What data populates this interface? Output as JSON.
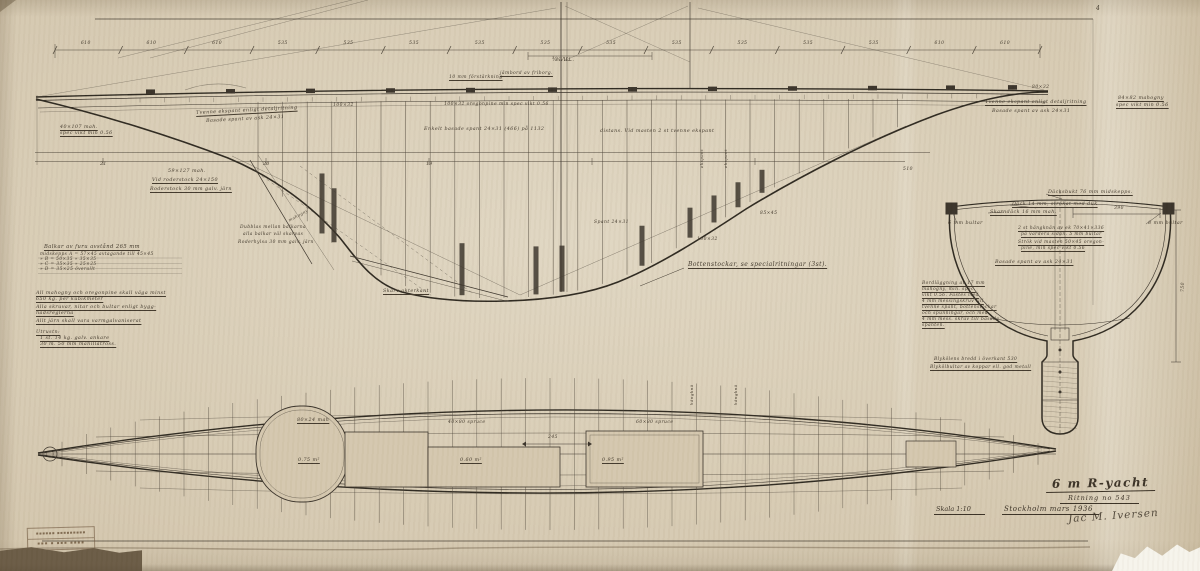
{
  "colors": {
    "paper": "#d3c6ad",
    "ink": "#3a332a",
    "heavy_ink": "#2e2920",
    "backing": "#6a5b45",
    "torn_paper": "#f6f4ec"
  },
  "title_block": {
    "title": "6 m R-yacht",
    "drawing_no": "Ritning no 543",
    "scale": "Skala 1:10",
    "place_date": "Stockholm mars 1936",
    "signature": "Jac M. Iversen"
  },
  "corner_mark": "4",
  "stamp": {
    "line1": "▪▪▪▪▪▪ ▪▪▪▪▪▪▪▪▪",
    "line2": "▪▪▪ ▪ ▪▪▪ ▪▪▪▪"
  },
  "top_dimensions": {
    "values": [
      "610",
      "610",
      "610",
      "535",
      "535",
      "535",
      "535",
      "535",
      "535",
      "535",
      "535",
      "535",
      "535",
      "610",
      "610"
    ],
    "sub_label": "¾ V.L."
  },
  "station_numbers": [
    "21",
    "20",
    "19"
  ],
  "notes_left": {
    "heading": "Balkar av furu avstånd 265 mm",
    "beam_table": [
      "midskepps   A = 57×45   avtagande till   45×45",
      "     »           B = 50×35           »           35×35",
      "     »           C = 35×35           »           25×25",
      "     »           D = 35×25      överallt"
    ],
    "notes": [
      [
        "All mahogny och oregonpine skall väga minst",
        "650 kg. per kubikmeter"
      ],
      [
        "Alla skruvar, nitar och bultar enligt bygg-",
        "nadsreglerna"
      ],
      [
        "Allt järn skall vara varmgalvaniserat"
      ],
      [
        "Utrustn:",
        "1 st. 14 kg. galv. ankare",
        "30 m. 50 mm manillatross."
      ]
    ]
  },
  "profile_labels": [
    {
      "text": "¾ V.L.",
      "x": 552,
      "y": 58,
      "size": 5.5
    },
    {
      "text": "10 mm förstärkning",
      "x": 449,
      "y": 76,
      "u": 1,
      "size": 4.5
    },
    {
      "text": "jämbord av friborg.",
      "x": 500,
      "y": 72,
      "u": 1,
      "size": 4.5
    },
    {
      "text": "100×32",
      "x": 333,
      "y": 104,
      "size": 4.5
    },
    {
      "text": "100×32   oregonpine   min spec vikt 0.56",
      "x": 444,
      "y": 103,
      "size": 4.5
    },
    {
      "text": "Enkelt basade spant 24×31 (466) på 1132",
      "x": 424,
      "y": 128,
      "size": 4.8
    },
    {
      "text": "distans. Vid masten 2 st tvenne ekspant",
      "x": 600,
      "y": 130,
      "size": 4.8
    },
    {
      "text": "Tvenne ekspant enligt detaljritning",
      "x": 196,
      "y": 112,
      "u": 1,
      "r": -3,
      "size": 4.8
    },
    {
      "text": "Basade spant av ask 24×31",
      "x": 206,
      "y": 120,
      "r": -3,
      "size": 4.8
    },
    {
      "text": "40×107 mah.",
      "x": 60,
      "y": 126,
      "u": 1,
      "size": 4.8
    },
    {
      "text": "spec vikt min 0.56",
      "x": 60,
      "y": 132,
      "u": 1,
      "size": 4.8
    },
    {
      "text": "59×127 mah.",
      "x": 168,
      "y": 170,
      "size": 4.8
    },
    {
      "text": "Vid roderstock 24×150",
      "x": 152,
      "y": 179,
      "u": 1,
      "size": 4.8
    },
    {
      "text": "Roderstock 30 mm galv. järn",
      "x": 150,
      "y": 188,
      "u": 1,
      "size": 4.8
    },
    {
      "text": "Dubblas mellan balkarna",
      "x": 240,
      "y": 226,
      "size": 4.4
    },
    {
      "text": "alla balkar väl skarvas",
      "x": 243,
      "y": 233,
      "size": 4.4
    },
    {
      "text": "Roderhylsa 30 mm galv. järn",
      "x": 238,
      "y": 241,
      "size": 4.4
    },
    {
      "text": "mahogny",
      "x": 288,
      "y": 219,
      "r": -28,
      "size": 4
    },
    {
      "text": "Skarv akterkant",
      "x": 383,
      "y": 290,
      "u": 1,
      "size": 4.8
    },
    {
      "text": "Bottenstockar, se specialritningar (3st).",
      "x": 688,
      "y": 262,
      "u": 1,
      "size": 6
    },
    {
      "text": "100×32",
      "x": 697,
      "y": 238,
      "size": 4.5
    },
    {
      "text": "85×45",
      "x": 760,
      "y": 212,
      "size": 4.5
    },
    {
      "text": "Spant 24×31",
      "x": 594,
      "y": 221,
      "size": 4.5
    },
    {
      "text": "ekspant",
      "x": 700,
      "y": 168,
      "r": -90,
      "size": 4
    },
    {
      "text": "ekspant",
      "x": 724,
      "y": 168,
      "r": -90,
      "size": 4
    },
    {
      "text": "Tvenne ekspant enligt detaljritning",
      "x": 985,
      "y": 101,
      "u": 1,
      "size": 4.8
    },
    {
      "text": "Basade spant av ask 24×31",
      "x": 992,
      "y": 110,
      "size": 4.8
    },
    {
      "text": "80×32",
      "x": 1032,
      "y": 86,
      "size": 4.5
    },
    {
      "text": "84×82 mahogny",
      "x": 1118,
      "y": 97,
      "u": 1,
      "size": 4.8
    },
    {
      "text": "spec vikt min 0.56",
      "x": 1116,
      "y": 104,
      "u": 1,
      "size": 4.8
    },
    {
      "text": "510",
      "x": 903,
      "y": 168,
      "size": 4.5
    }
  ],
  "section_labels": [
    {
      "text": "Däcksbukt 76 mm midskepps.",
      "x": 1048,
      "y": 191,
      "u": 1,
      "size": 4.8
    },
    {
      "text": "Däck 14 mm, strökat med duk",
      "x": 1012,
      "y": 203,
      "u": 1,
      "size": 4.8
    },
    {
      "text": "Skarndäck 16 mm mah.",
      "x": 990,
      "y": 211,
      "u": 1,
      "size": 4.8
    },
    {
      "text": "6 mm bultar",
      "x": 948,
      "y": 222,
      "size": 4.8
    },
    {
      "text": "8 mm bultar",
      "x": 1148,
      "y": 222,
      "size": 4.8
    },
    {
      "text": "390",
      "x": 1114,
      "y": 207,
      "size": 4.5
    },
    {
      "text": "2 st hängknän av ek 70×41×336",
      "x": 1018,
      "y": 227,
      "u": 1,
      "size": 4.4
    },
    {
      "text": "på vardera sidan. 5 mm bultar",
      "x": 1021,
      "y": 233,
      "u": 1,
      "size": 4.4
    },
    {
      "text": "Strök vid masten 50×45 oregon-",
      "x": 1018,
      "y": 241,
      "u": 1,
      "size": 4.4
    },
    {
      "text": "pine, min spec vikt 0.56",
      "x": 1021,
      "y": 247,
      "u": 1,
      "size": 4.4
    },
    {
      "text": "Basade spant av ask 24×31",
      "x": 995,
      "y": 261,
      "u": 1,
      "size": 4.8
    },
    {
      "text": "Bordläggning av 17 mm",
      "x": 922,
      "y": 282,
      "u": 1,
      "size": 4.4
    },
    {
      "text": "mahogny, min. spec.",
      "x": 922,
      "y": 288,
      "u": 1,
      "size": 4.4
    },
    {
      "text": "vikt 0.56. Fästes med",
      "x": 922,
      "y": 294,
      "u": 1,
      "size": 4.4
    },
    {
      "text": "4 mm messingskruv till",
      "x": 922,
      "y": 300,
      "u": 1,
      "size": 4.4
    },
    {
      "text": "tvenne spant, bottenstockar",
      "x": 922,
      "y": 306,
      "u": 1,
      "size": 4.4
    },
    {
      "text": "och spunningar, och med",
      "x": 922,
      "y": 312,
      "u": 1,
      "size": 4.4
    },
    {
      "text": "4 mm mess. skruv till basade",
      "x": 922,
      "y": 318,
      "u": 1,
      "size": 4.4
    },
    {
      "text": "spanten.",
      "x": 922,
      "y": 324,
      "u": 1,
      "size": 4.4
    },
    {
      "text": "Blykölens bredd i överkant 530",
      "x": 934,
      "y": 358,
      "u": 1,
      "size": 4.4
    },
    {
      "text": "Blykölbultar av koppar ell. god metall",
      "x": 930,
      "y": 366,
      "u": 1,
      "size": 4.4
    },
    {
      "text": "750",
      "x": 1182,
      "y": 292,
      "r": -90,
      "size": 4.5
    }
  ],
  "plan_labels": [
    {
      "text": "80×24 mah",
      "x": 297,
      "y": 419,
      "u": 1,
      "size": 4.8
    },
    {
      "text": "0.75 m²",
      "x": 298,
      "y": 459,
      "u": 1,
      "size": 4.8
    },
    {
      "text": "40×80   spruce",
      "x": 448,
      "y": 421,
      "size": 4.5
    },
    {
      "text": "60×80   spruce",
      "x": 636,
      "y": 421,
      "size": 4.5
    },
    {
      "text": "245",
      "x": 548,
      "y": 436,
      "size": 4.5
    },
    {
      "text": "0.60 m²",
      "x": 460,
      "y": 459,
      "u": 1,
      "size": 4.8
    },
    {
      "text": "0.95 m²",
      "x": 602,
      "y": 459,
      "u": 1,
      "size": 4.8
    },
    {
      "text": "hängknä",
      "x": 690,
      "y": 405,
      "r": -90,
      "size": 4
    },
    {
      "text": "hängknä",
      "x": 734,
      "y": 405,
      "r": -90,
      "size": 4
    }
  ]
}
